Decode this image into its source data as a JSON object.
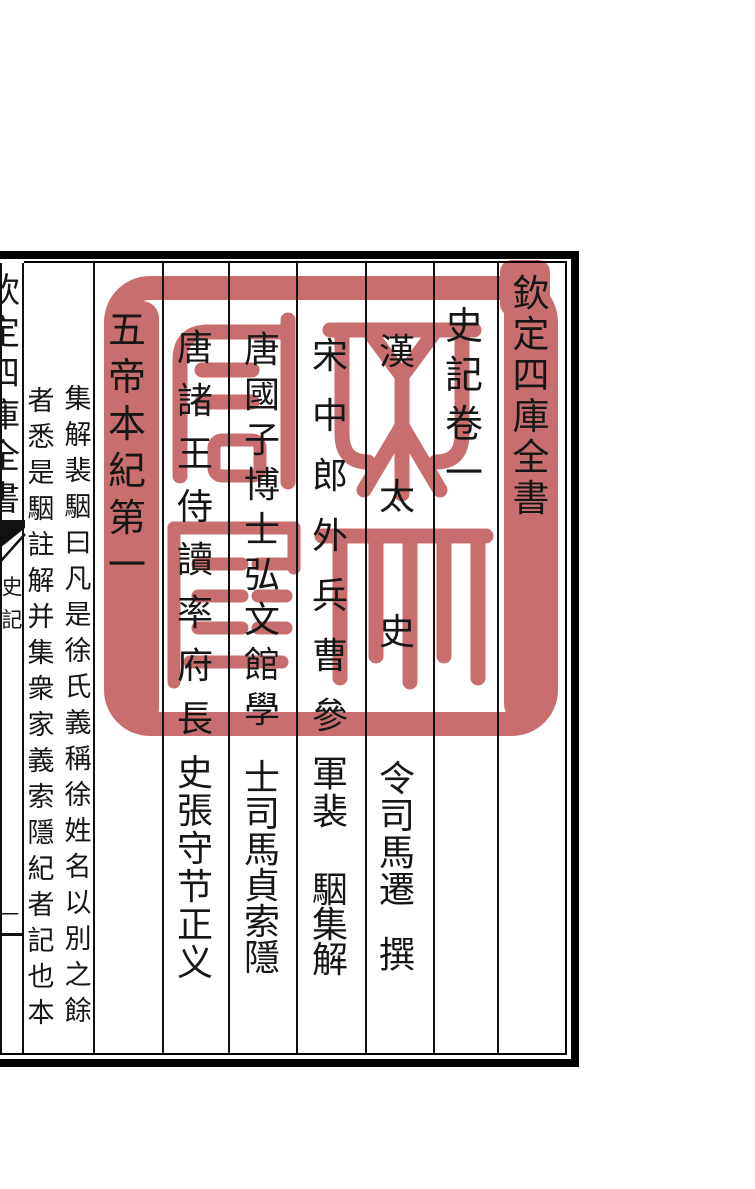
{
  "seal": {
    "text": "文淵閣寶",
    "color": "#c96e6e"
  },
  "frame": {
    "column_lines": [
      0,
      22,
      93,
      162,
      228,
      296,
      365,
      433,
      497
    ]
  },
  "columns": [
    {
      "name": "title-column",
      "x": 531,
      "size": 37,
      "segments": [
        {
          "text": "欽定四庫全書",
          "top": 276,
          "pitch": 41
        }
      ]
    },
    {
      "name": "chapter-column",
      "x": 464,
      "size": 38,
      "segments": [
        {
          "text": "史記卷一",
          "top": 308,
          "pitch": 49
        }
      ]
    },
    {
      "name": "author-column",
      "x": 397,
      "size": 36,
      "segments": [
        {
          "text": "漢",
          "top": 334,
          "pitch": 40
        },
        {
          "text": "太",
          "top": 479,
          "pitch": 40
        },
        {
          "text": "史",
          "top": 614,
          "pitch": 40
        },
        {
          "text": "令司馬遷",
          "top": 761,
          "pitch": 37
        },
        {
          "text": "撰",
          "top": 937,
          "pitch": 40
        }
      ]
    },
    {
      "name": "jijie-commentator-column",
      "x": 330,
      "size": 36,
      "segments": [
        {
          "text": "宋中郎外兵曹參",
          "top": 338,
          "pitch": 60
        },
        {
          "text": "軍裴",
          "top": 756,
          "pitch": 38
        },
        {
          "text": "駰集解",
          "top": 872,
          "pitch": 35
        }
      ]
    },
    {
      "name": "suoyin-commentator-column",
      "x": 262,
      "size": 36,
      "segments": [
        {
          "text": "唐國子博士弘文館學",
          "top": 332,
          "pitch": 45
        },
        {
          "text": "士司馬貞索隱",
          "top": 760,
          "pitch": 36
        }
      ]
    },
    {
      "name": "zhengyi-commentator-column",
      "x": 195,
      "size": 36,
      "segments": [
        {
          "text": "唐諸王侍讀率府長",
          "top": 330,
          "pitch": 53
        },
        {
          "text": "史張守节正义",
          "top": 755,
          "pitch": 38
        }
      ]
    },
    {
      "name": "chapter-title-column",
      "x": 127,
      "size": 38,
      "segments": [
        {
          "text": "五帝本紀第一",
          "top": 312,
          "pitch": 47
        }
      ]
    },
    {
      "name": "annotation-sub-right",
      "x": 78,
      "size": 27,
      "segments": [
        {
          "text": "集解裴駰曰凡是徐氏義稱徐姓名以別之餘",
          "top": 386,
          "pitch": 36
        }
      ]
    },
    {
      "name": "annotation-sub-left",
      "x": 41,
      "size": 27,
      "segments": [
        {
          "text": "者悉是駰註解并集衆家義索隱紀者記也本",
          "top": 388,
          "pitch": 36
        }
      ]
    },
    {
      "name": "banxin-series-title",
      "x": 3,
      "size": 34,
      "segments": [
        {
          "text": "欽定四庫全書",
          "top": 275,
          "pitch": 41.5
        }
      ]
    },
    {
      "name": "banxin-book-title",
      "x": 12,
      "size": 21,
      "segments": [
        {
          "text": "史記",
          "top": 577,
          "pitch": 33
        }
      ]
    },
    {
      "name": "banxin-page-number",
      "x": 10,
      "size": 18,
      "segments": [
        {
          "text": "一",
          "top": 906,
          "pitch": 20
        }
      ]
    }
  ]
}
